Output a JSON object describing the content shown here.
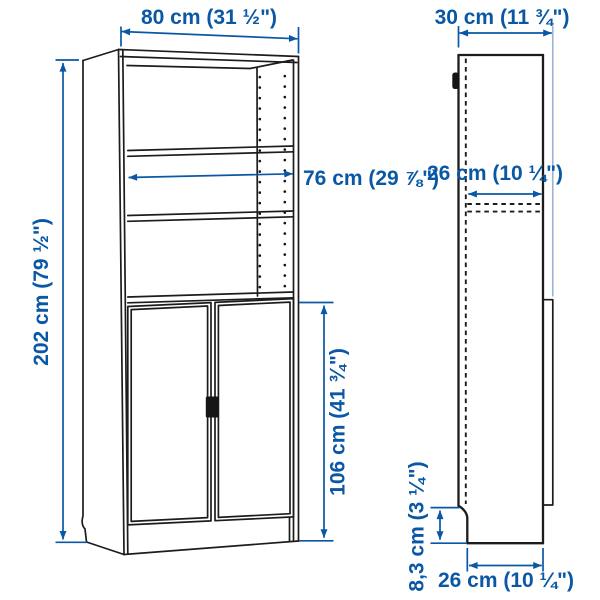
{
  "figure": {
    "kind": "product-dimension-diagram",
    "subject": "tall bookcase with doors, front view and side view line drawing",
    "views": {
      "front": {
        "name": "front-view",
        "dimensions": {
          "width": "80 cm (31 ½\")",
          "inner_width": "76 cm (29 ⅞\")",
          "height": "202 cm (79 ½\")",
          "door_height": "106 cm (41 ¾\")"
        }
      },
      "side": {
        "name": "side-view",
        "dimensions": {
          "total_depth": "30 cm (11 ¾\")",
          "shelf_depth": "26 cm (10 ¼\")",
          "plinth_height": "8,3 cm (3 ¼\")",
          "floor_depth": "26 cm (10 ¼\")"
        }
      }
    },
    "colors": {
      "dimension_blue": "#0a58a5",
      "extension_light_blue": "#97b1d4",
      "line_black": "#1c1c1c",
      "background": "#ffffff"
    }
  }
}
